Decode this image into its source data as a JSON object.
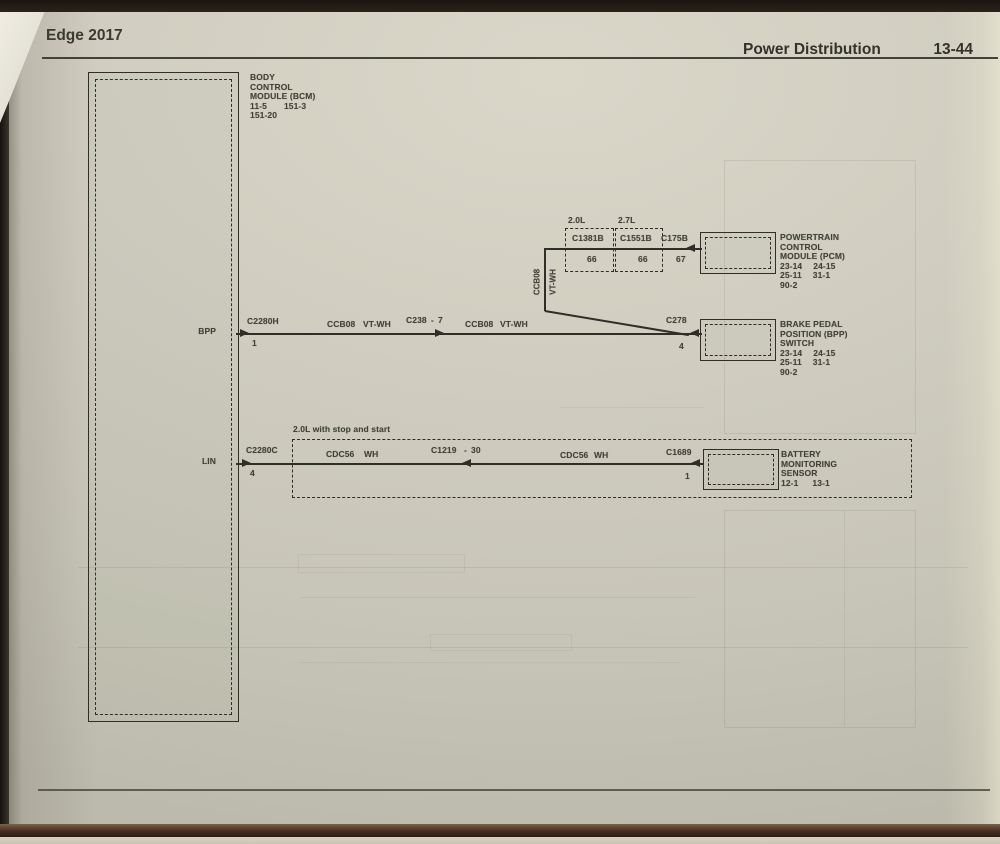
{
  "photo": {
    "paper_color": "#cfccc0",
    "ink_color": "#43433a",
    "line_color": "#2f2f28"
  },
  "header": {
    "left_title": "Edge 2017",
    "section_title": "Power Distribution",
    "page_number": "13-44"
  },
  "bcm": {
    "name": [
      "BODY",
      "CONTROL",
      "MODULE (BCM)"
    ],
    "refs_row1": [
      "11-5",
      "151-3"
    ],
    "refs_row2": "151-20",
    "pin_bpp_label": "BPP",
    "pin_lin_label": "LIN"
  },
  "bpp_circuit": {
    "connector": "C2280H",
    "pin": "1",
    "seg1_circuit": "CCB08",
    "seg1_color": "VT-WH",
    "inline_connector": "C238",
    "inline_sep": "-",
    "inline_pin": "7",
    "seg2_circuit": "CCB08",
    "seg2_color": "VT-WH",
    "switch_connector": "C278",
    "switch_pin": "4"
  },
  "branch_pcm": {
    "vert_circuit": "CCB08",
    "vert_color": "VT-WH",
    "engine1_label": "2.0L",
    "engine1_connector": "C1381B",
    "engine1_pin": "66",
    "engine2_label": "2.7L",
    "engine2_connector": "C1551B",
    "engine2_pin": "66",
    "pcm_connector": "C175B",
    "pcm_pin": "67"
  },
  "pcm": {
    "name": [
      "POWERTRAIN",
      "CONTROL",
      "MODULE (PCM)"
    ],
    "refs_row1": [
      "23-14",
      "24-15"
    ],
    "refs_row2": [
      "25-11",
      "31-1"
    ],
    "refs_row3": "90-2"
  },
  "bpp_switch": {
    "name": [
      "BRAKE PEDAL",
      "POSITION (BPP)",
      "SWITCH"
    ],
    "refs_row1": [
      "23-14",
      "24-15"
    ],
    "refs_row2": [
      "25-11",
      "31-1"
    ],
    "refs_row3": "90-2"
  },
  "lin_circuit": {
    "connector": "C2280C",
    "pin": "4",
    "option_label": "2.0L with stop and start",
    "seg1_circuit": "CDC56",
    "seg1_color": "WH",
    "inline_connector": "C1219",
    "inline_sep": "-",
    "inline_pin": "30",
    "seg2_circuit": "CDC56",
    "seg2_color": "WH",
    "sensor_connector": "C1689",
    "sensor_pin": "1"
  },
  "battery_sensor": {
    "name": [
      "BATTERY",
      "MONITORING",
      "SENSOR"
    ],
    "refs_row1": [
      "12-1",
      "13-1"
    ]
  }
}
